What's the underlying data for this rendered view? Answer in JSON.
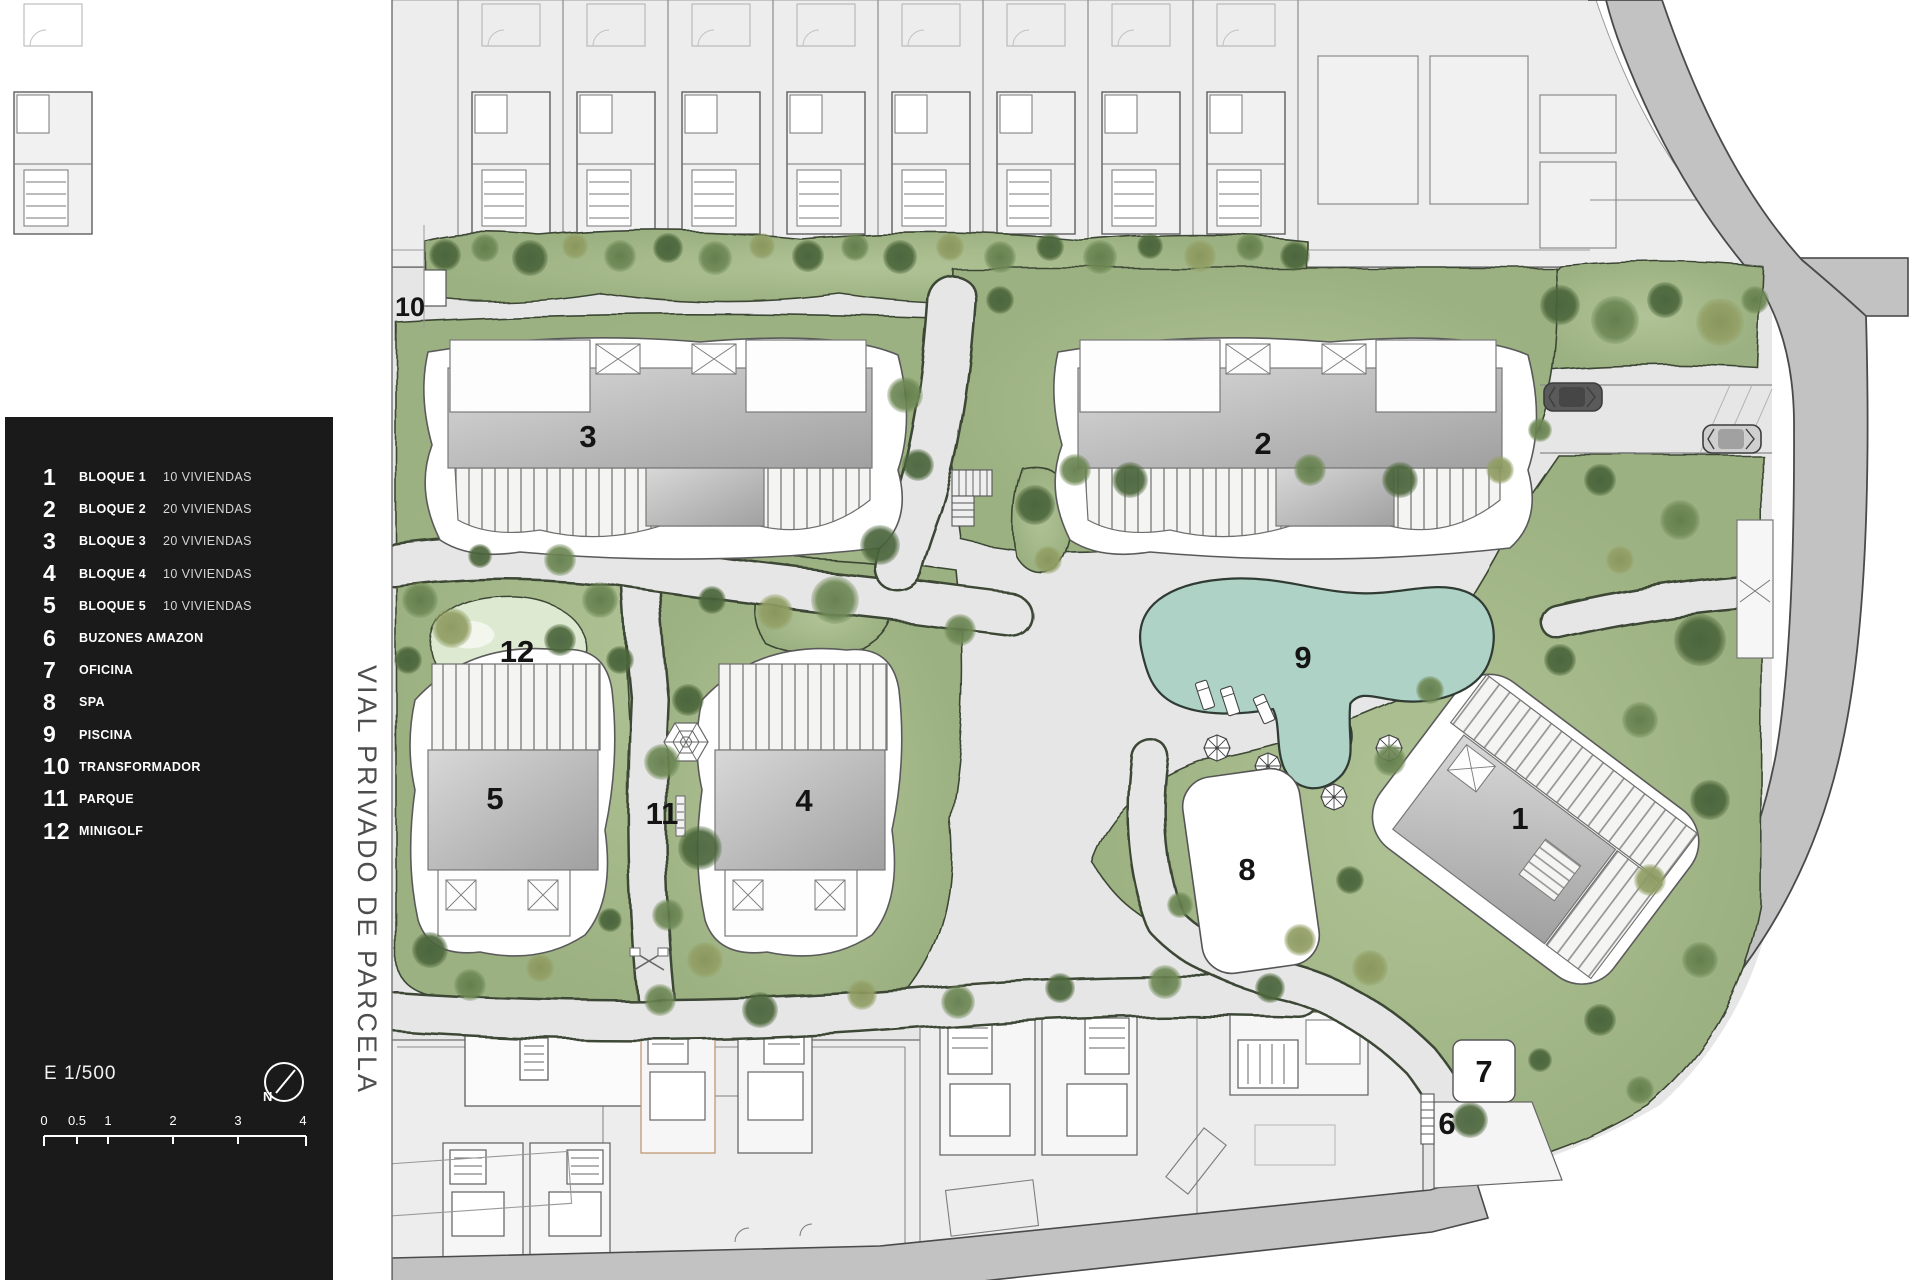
{
  "legend": {
    "items": [
      {
        "num": "1",
        "label": "BLOQUE 1",
        "detail": "10 VIVIENDAS"
      },
      {
        "num": "2",
        "label": "BLOQUE 2",
        "detail": "20 VIVIENDAS"
      },
      {
        "num": "3",
        "label": "BLOQUE 3",
        "detail": "20 VIVIENDAS"
      },
      {
        "num": "4",
        "label": "BLOQUE 4",
        "detail": "10 VIVIENDAS"
      },
      {
        "num": "5",
        "label": "BLOQUE 5",
        "detail": "10 VIVIENDAS"
      },
      {
        "num": "6",
        "label": "BUZONES AMAZON",
        "detail": ""
      },
      {
        "num": "7",
        "label": "OFICINA",
        "detail": ""
      },
      {
        "num": "8",
        "label": "SPA",
        "detail": ""
      },
      {
        "num": "9",
        "label": "PISCINA",
        "detail": ""
      },
      {
        "num": "10",
        "label": "TRANSFORMADOR",
        "detail": ""
      },
      {
        "num": "11",
        "label": "PARQUE",
        "detail": ""
      },
      {
        "num": "12",
        "label": "MINIGOLF",
        "detail": ""
      }
    ],
    "scale_label": "E 1/500",
    "north_label": "N",
    "scale_ticks": [
      "0",
      "0.5",
      "1",
      "2",
      "3",
      "4"
    ]
  },
  "street": {
    "name": "VIAL PRIVADO DE PARCELA"
  },
  "plan": {
    "labels": {
      "block1": "1",
      "block2": "2",
      "block3": "3",
      "block4": "4",
      "block5": "5",
      "buzones": "6",
      "oficina": "7",
      "spa": "8",
      "piscina": "9",
      "transformador": "10",
      "parque": "11",
      "minigolf": "12"
    }
  },
  "colors": {
    "legend_bg": "#1a1a1a",
    "paper": "#ffffff",
    "path_gray": "#e6e6e6",
    "neighbor_gray": "#ededed",
    "road_gray": "#c2c2c2",
    "grass": "#a5ba8b",
    "grass_dark_edge": "#3c4734",
    "tree_dark": "#4e683d",
    "tree_mid": "#708a57",
    "tree_olive": "#93a066",
    "pool": "#afd2c6",
    "pool_shallow": "#d4e6dd",
    "minigolf_green": "#dde9d0",
    "building_gray": "#b5b5b5",
    "label_ink": "#141414"
  }
}
